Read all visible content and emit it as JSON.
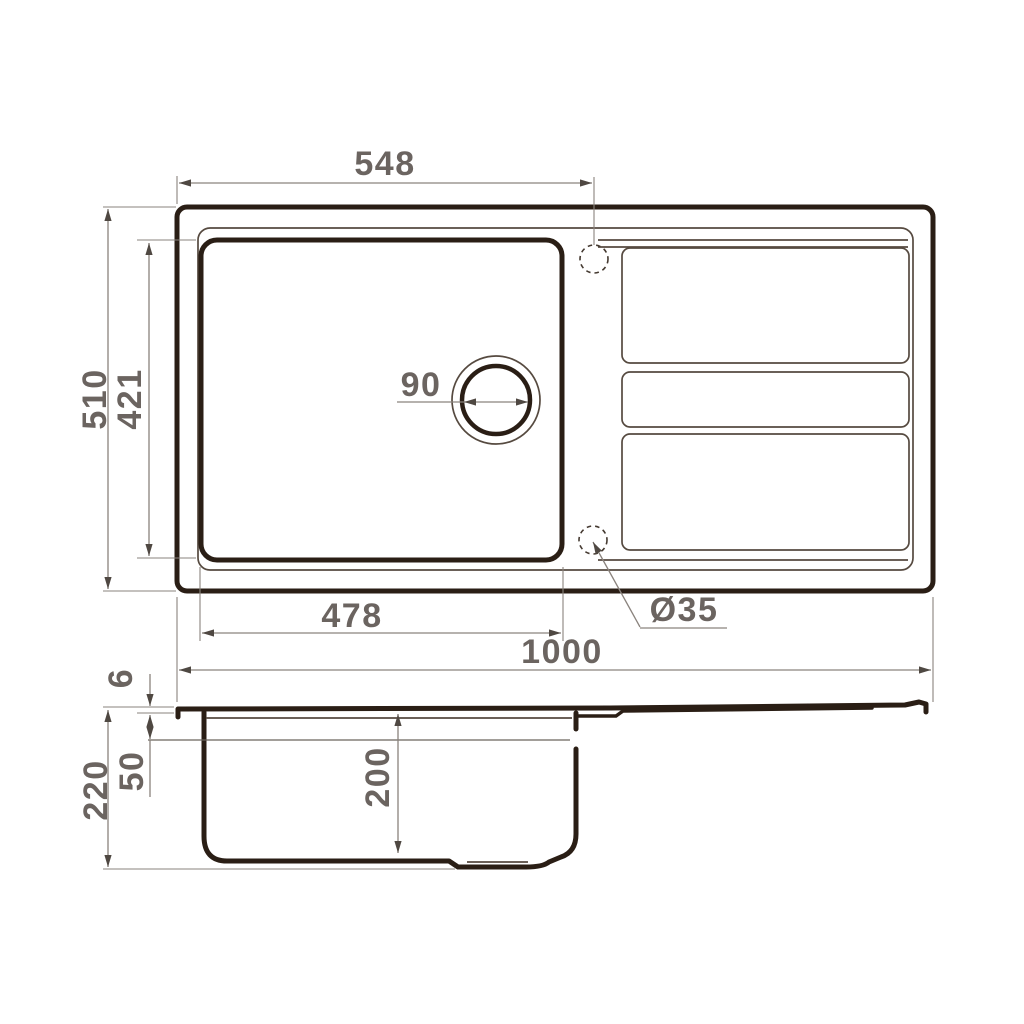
{
  "drawing": {
    "dimensions": {
      "top_width": "548",
      "overall_depth": "510",
      "bowl_inner_depth": "421",
      "drain_diameter": "90",
      "bowl_inner_width": "478",
      "tap_hole_diameter": "Ø35",
      "overall_width": "1000",
      "rim_height": "6",
      "ledge_depth": "50",
      "overall_height": "220",
      "bowl_depth": "200"
    },
    "colors": {
      "outline_dark": "#2a1e15",
      "outline_thin": "#564a40",
      "dimension_line": "#8a837d",
      "dimension_text": "#6b6460",
      "background": "#ffffff"
    }
  }
}
